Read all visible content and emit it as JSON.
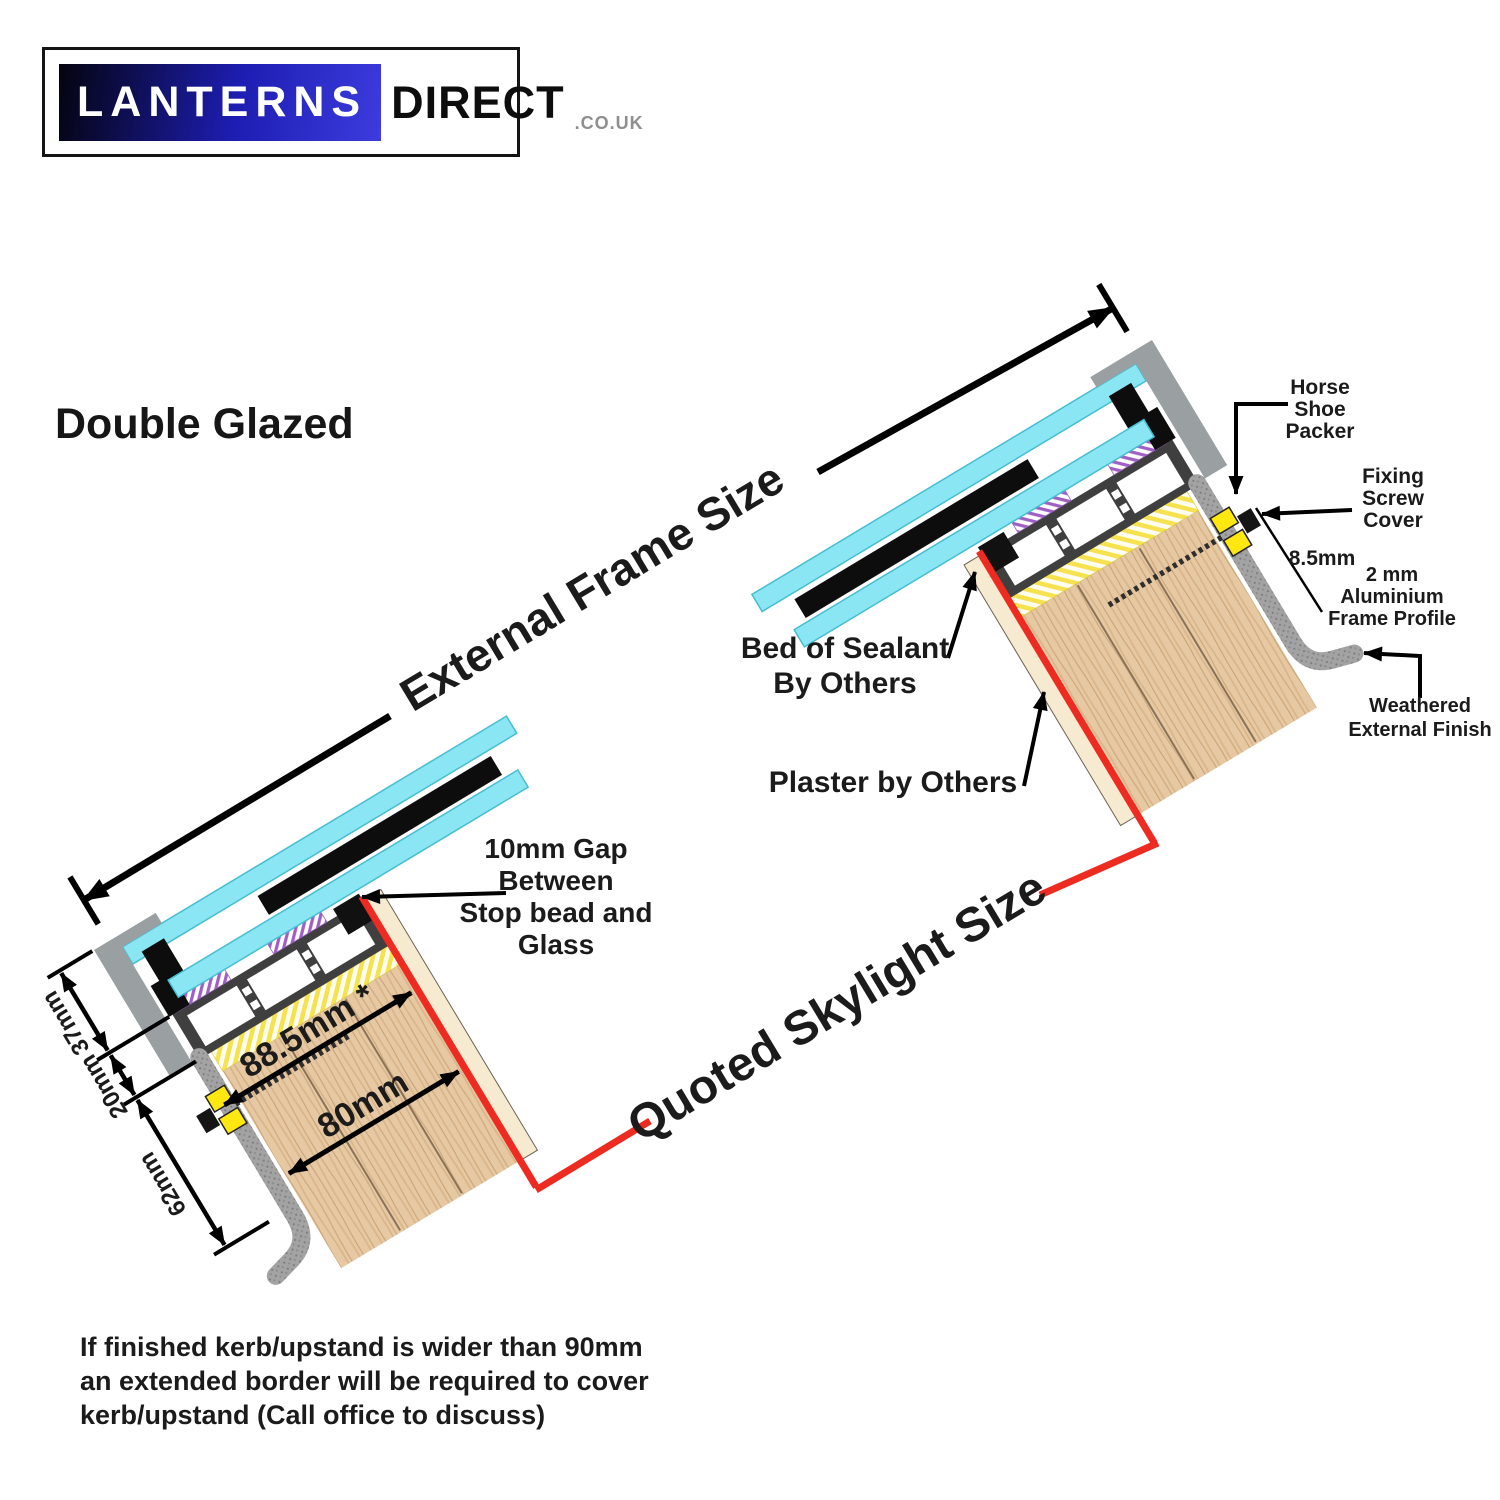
{
  "logo": {
    "brand_primary": "LANTERNS",
    "brand_secondary": "DIRECT",
    "brand_suffix": ".CO.UK"
  },
  "title": "Double Glazed",
  "diagram": {
    "external_frame_size": "External Frame Size",
    "quoted_skylight_size": "Quoted Skylight Size",
    "labels": {
      "horse_shoe_packer": [
        "Horse",
        "Shoe",
        "Packer"
      ],
      "fixing_screw_cover": [
        "Fixing",
        "Screw",
        "Cover"
      ],
      "screw_offset": "8.5mm",
      "frame_profile": [
        "2 mm",
        "Aluminium",
        "Frame Profile"
      ],
      "weathered_finish": [
        "Weathered",
        "External Finish"
      ],
      "bed_of_sealant": [
        "Bed of Sealant",
        "By Others"
      ],
      "plaster": "Plaster by Others",
      "gap": [
        "10mm Gap",
        "Between",
        "Stop bead and",
        "Glass"
      ]
    },
    "dimensions": {
      "glazing_stack": "37mm",
      "frame_height": "20mm",
      "profile_drop": "62mm",
      "kerb_overall": "88.5mm *",
      "kerb_width": "80mm"
    },
    "colors": {
      "glass": "#8BE6F4",
      "frame": "#3F3F3F",
      "wood": "#E6C9A3",
      "quoted_line_red": "#EE2B21",
      "packer_yellow": "#FFE70F",
      "profile_gray": "#A3A3A3",
      "hatch_purple": "#A05FC4",
      "hatch_yellow": "#F6E14E"
    }
  },
  "footnote": [
    "If finished kerb/upstand is wider than 90mm",
    "an extended border will be required to cover",
    "kerb/upstand (Call office to discuss)"
  ]
}
